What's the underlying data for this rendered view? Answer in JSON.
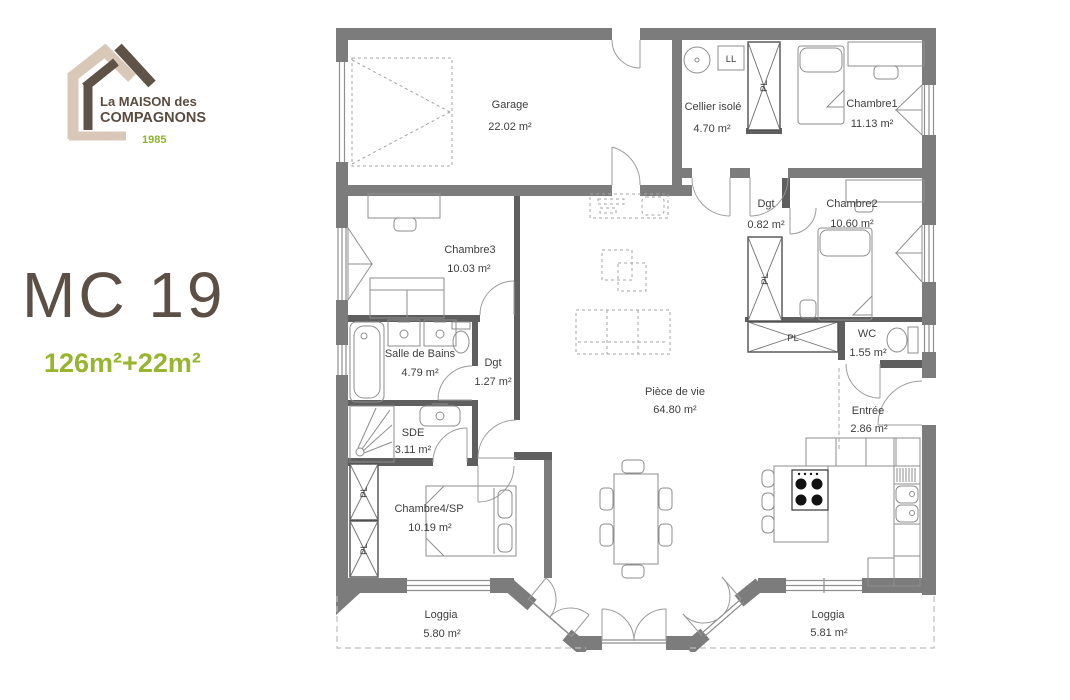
{
  "branding": {
    "logo_line1": "La MAISON des",
    "logo_line2": "COMPAGNONS",
    "logo_year": "1985",
    "colors": {
      "brand_brown": "#5c5046",
      "brand_beige": "#d9c8b8",
      "brand_green": "#97b52f",
      "wall_gray": "#7c7c7c"
    }
  },
  "plan_title": {
    "code": "MC 19",
    "surface": "126m²+22m²"
  },
  "plan": {
    "rooms": {
      "garage": {
        "name": "Garage",
        "area": "22.02 m²"
      },
      "cellier": {
        "name": "Cellier isolé",
        "area": "4.70 m²"
      },
      "chambre1": {
        "name": "Chambre1",
        "area": "11.13 m²"
      },
      "dgt_hall": {
        "name": "Dgt",
        "area": "0.82 m²"
      },
      "chambre2": {
        "name": "Chambre2",
        "area": "10.60 m²"
      },
      "wc": {
        "name": "WC",
        "area": "1.55 m²"
      },
      "chambre3": {
        "name": "Chambre3",
        "area": "10.03 m²"
      },
      "salle_de_bains": {
        "name": "Salle de Bains",
        "area": "4.79 m²"
      },
      "dgt_corridor": {
        "name": "Dgt",
        "area": "1.27 m²"
      },
      "sde": {
        "name": "SDE",
        "area": "3.11 m²"
      },
      "chambre4": {
        "name": "Chambre4/SP",
        "area": "10.19 m²"
      },
      "piece_de_vie": {
        "name": "Pièce de vie",
        "area": "64.80 m²"
      },
      "entree": {
        "name": "Entrée",
        "area": "2.86 m²"
      },
      "loggia_left": {
        "name": "Loggia",
        "area": "5.80 m²"
      },
      "loggia_right": {
        "name": "Loggia",
        "area": "5.81 m²"
      }
    },
    "fixtures": {
      "washing_machine": "LL",
      "closet": "PL"
    }
  }
}
